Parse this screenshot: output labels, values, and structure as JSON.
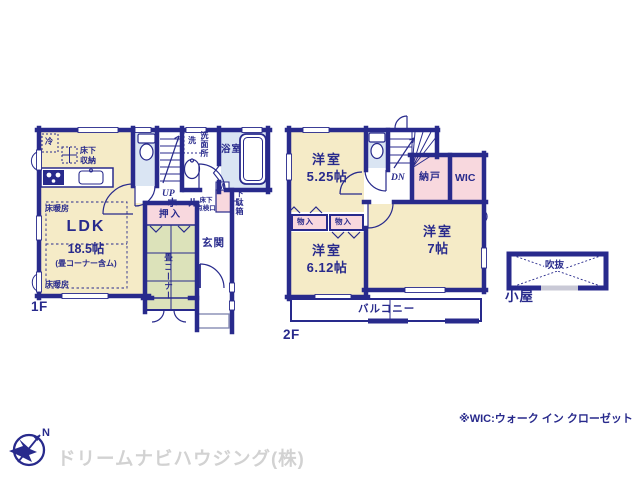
{
  "colors": {
    "wall_navy": "#282a8c",
    "room_cream": "#f5ebc7",
    "closet_pink": "#f8d8de",
    "water_blue": "#dae5f3",
    "tatami_green": "#dce2ba",
    "logo_gray": "#d2d2d2"
  },
  "floor1": {
    "label": "1F",
    "ldk": {
      "name": "LDK",
      "size": "18.5帖",
      "note": "(畳コーナー含ム)"
    },
    "heated_floor": "床暖房",
    "fridge": "冷",
    "underfloor_storage": "床下\n収納",
    "washer": "洗",
    "washroom": "洗面所",
    "bathroom": "浴室",
    "stairs_up": "UP",
    "hall": "ホール",
    "meter_box": "M",
    "shoe_cabinet": "下駄箱",
    "inspection_hatch": "床下\n点検口",
    "closet": "押入",
    "entrance": "玄関",
    "tatami_corner": "畳コーナー"
  },
  "floor2": {
    "label": "2F",
    "room_a": {
      "name": "洋室",
      "size": "5.25帖"
    },
    "room_b": {
      "name": "洋室",
      "size": "6.12帖"
    },
    "room_c": {
      "name": "洋室",
      "size": "7帖"
    },
    "stairs_down": "DN",
    "storage_room": "納戸",
    "walk_in_closet": "WIC",
    "storage_1": "物入",
    "storage_2": "物入",
    "balcony": "バルコニー"
  },
  "attic": {
    "void": "吹抜",
    "label": "小屋"
  },
  "footer": {
    "note": "※WIC:ウォーク イン クローゼット",
    "company": "ドリームナビハウジング(株)",
    "compass_north": "N"
  }
}
